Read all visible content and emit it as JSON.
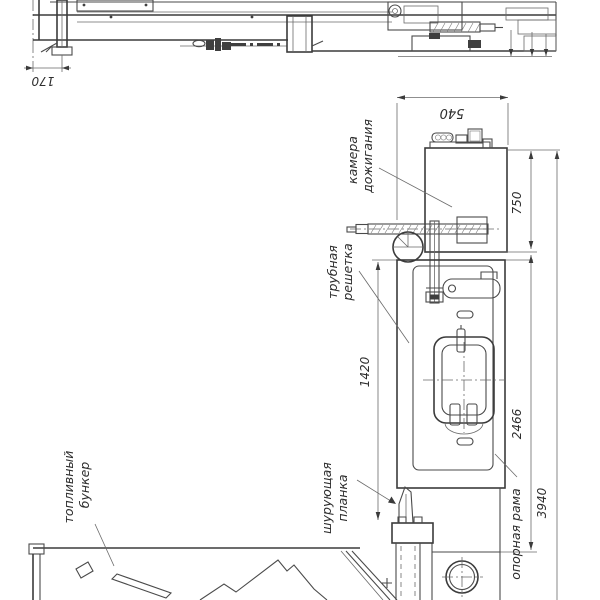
{
  "drawing": {
    "type": "technical-drawing",
    "labels": {
      "kamera": {
        "line1": "камера",
        "line2": "дожигания"
      },
      "trubnaya": {
        "line1": "трубная",
        "line2": "решетка"
      },
      "toplivny": {
        "line1": "топливный",
        "line2": "бункер"
      },
      "planka": {
        "line1": "шурующая",
        "line2": "планка"
      },
      "rama": {
        "text": "опорная рама"
      }
    },
    "dims": {
      "d170": "170",
      "d540": "540",
      "d750": "750",
      "d1420": "1420",
      "d2466": "2466",
      "d3940": "3940"
    },
    "colors": {
      "line": "#3b3b3b",
      "thin_line": "#6a6a6a",
      "background": "#ffffff"
    }
  }
}
